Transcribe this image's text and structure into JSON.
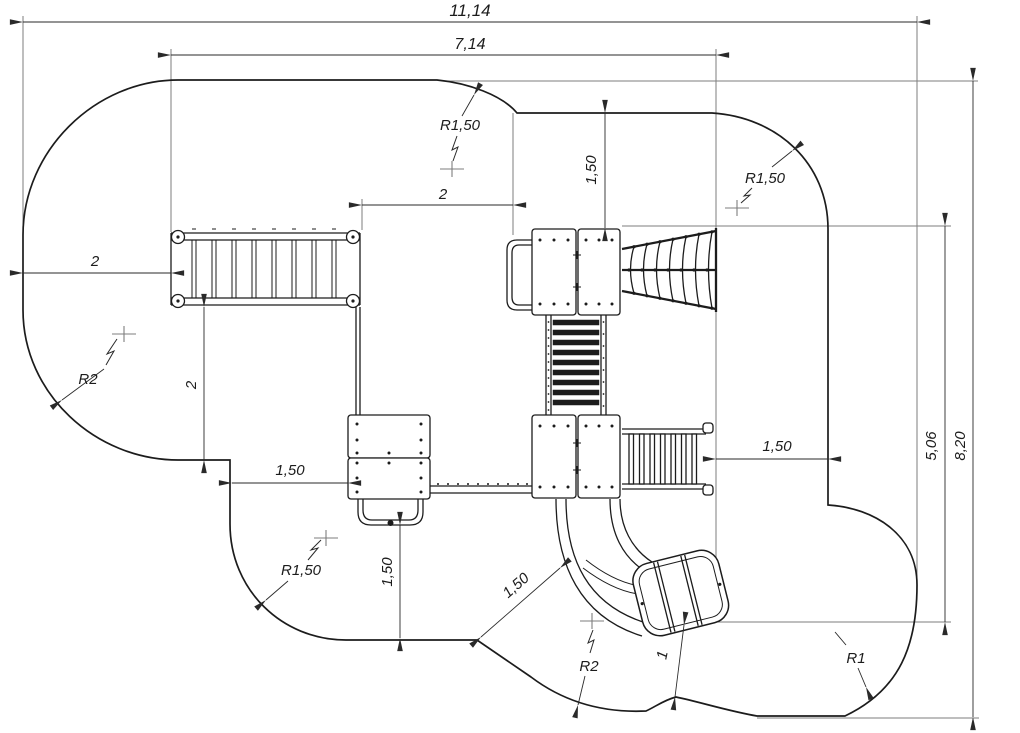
{
  "drawing": {
    "type": "plan-technical-drawing",
    "subject": "playground equipment layout with safety zone boundary",
    "units": "meters",
    "line_color": "#1c1c1c",
    "extension_line_color": "#7d7d7d",
    "background_color": "#ffffff"
  },
  "labels": {
    "overall_width": "11,14",
    "inner_width": "7,14",
    "top_offset": "2",
    "top_clearance_vertical": "1,50",
    "radius_top_center": "R1,50",
    "radius_top_right": "R1,50",
    "left_clearance": "2",
    "radius_top_left": "R2",
    "left_mid_clearance": "2",
    "bottom_left_clearance": "1,50",
    "radius_bottom_left": "R1,50",
    "bottom_vertical_clearance": "1,50",
    "slide_diagonal_clearance": "1,50",
    "radius_bottom_center": "R2",
    "slide_exit_clearance": "1",
    "radius_bottom_right": "R1",
    "right_clearance": "1,50",
    "inner_height": "5,06",
    "overall_height": "8,20"
  }
}
